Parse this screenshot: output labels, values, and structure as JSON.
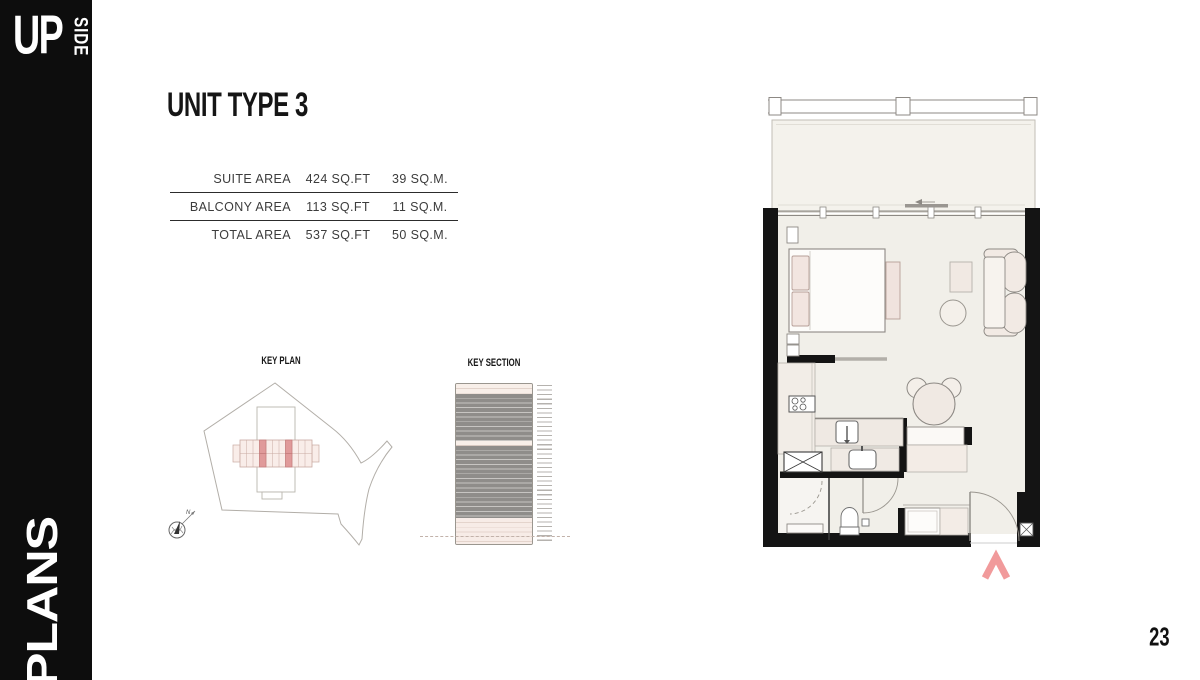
{
  "sidebar": {
    "brand_top": "UP",
    "brand_side": "SIDE",
    "section_label": "PLANS"
  },
  "page": {
    "title": "UNIT TYPE 3",
    "number": "23"
  },
  "area_table": {
    "rows": [
      {
        "label": "SUITE AREA",
        "sqft": "424 SQ.FT",
        "sqm": "39 SQ.M."
      },
      {
        "label": "BALCONY AREA",
        "sqft": "113 SQ.FT",
        "sqm": "11 SQ.M."
      },
      {
        "label": "TOTAL AREA",
        "sqft": "537 SQ.FT",
        "sqm": "50 SQ.M."
      }
    ]
  },
  "key_plan": {
    "label": "KEY PLAN",
    "north_label": "N"
  },
  "key_section": {
    "label": "KEY SECTION"
  },
  "colors": {
    "wall_black": "#141414",
    "floor": "#f1efe9",
    "furniture_pink": "#f2e5e0",
    "highlight_unit_pink": "#e09a9a",
    "orientation_arrow_pink": "#f19a9b",
    "section_gray": "#8f8d8a"
  }
}
